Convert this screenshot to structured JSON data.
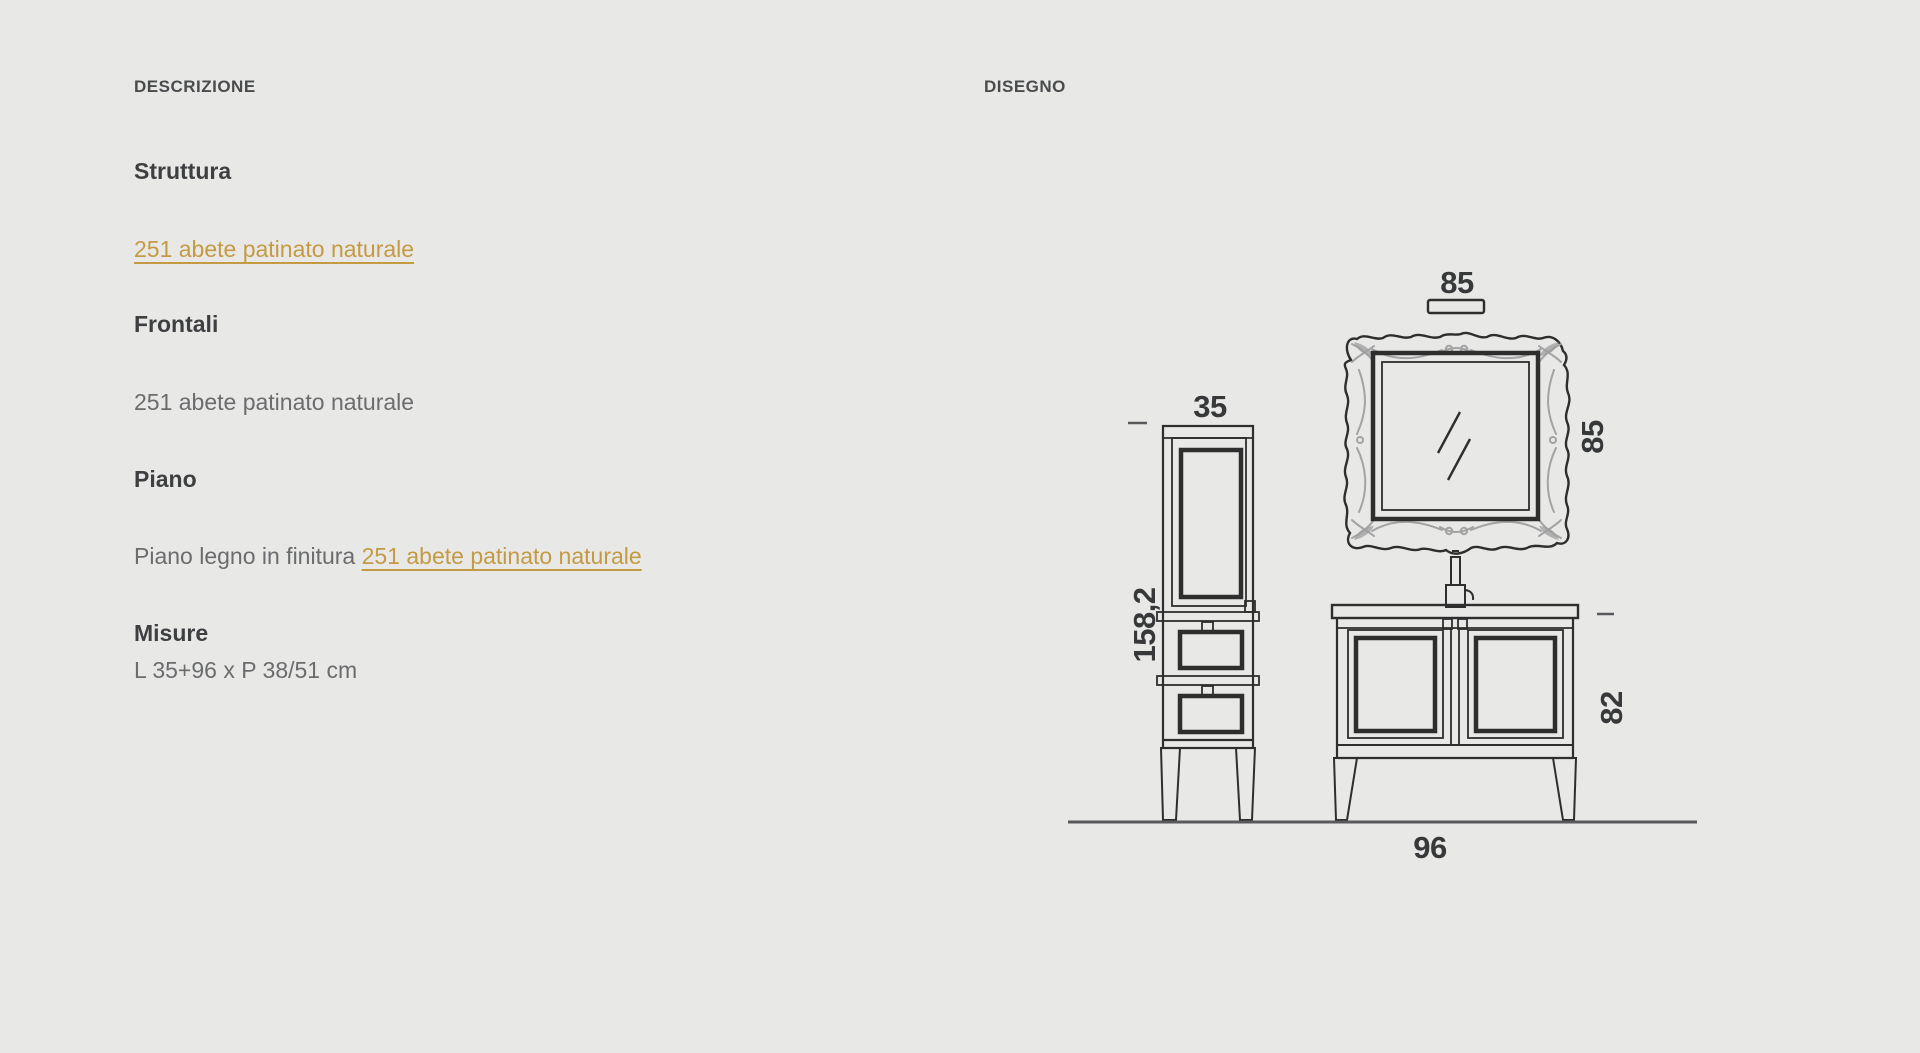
{
  "page": {
    "background_color": "#e8e8e7",
    "accent_color": "#c49a43"
  },
  "columns": {
    "description": {
      "label": "DESCRIZIONE",
      "sections": [
        {
          "heading": "Struttura",
          "value": "251 abete patinato naturale",
          "value_is_link": true
        },
        {
          "heading": "Frontali",
          "value": "251 abete patinato naturale",
          "value_is_link": false
        },
        {
          "heading": "Piano",
          "value_prefix": "Piano legno in finitura ",
          "value_link": "251 abete patinato naturale"
        },
        {
          "heading": "Misure",
          "value": "L 35+96 x P 38/51 cm",
          "value_is_link": false
        }
      ]
    },
    "drawing": {
      "label": "DISEGNO",
      "items": [
        "tall side column",
        "ornate framed mirror",
        "vanity cabinet with faucet"
      ],
      "dimensions": {
        "column_width_cm": "35",
        "column_height_cm": "158,2",
        "mirror_width_cm": "85",
        "mirror_height_cm": "85",
        "vanity_height_cm": "82",
        "vanity_width_cm": "96"
      }
    }
  }
}
